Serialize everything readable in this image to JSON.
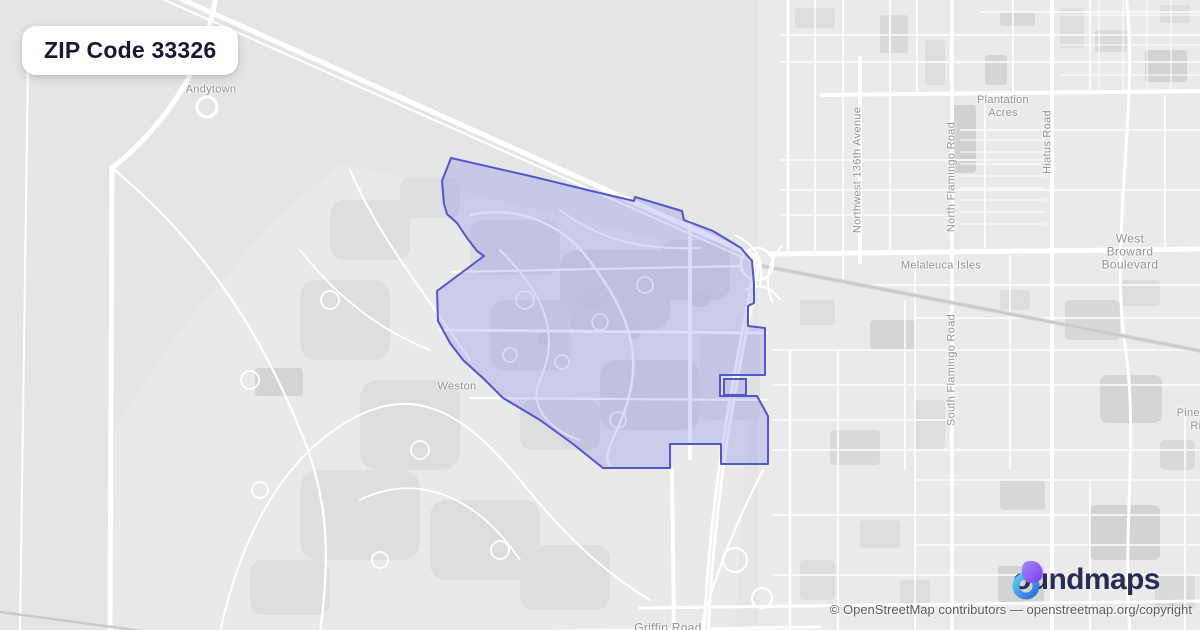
{
  "badge": {
    "label": "ZIP Code 33326"
  },
  "labels": {
    "andytown": "Andytown",
    "plantation_acres": "Plantation\nAcres",
    "melaleuca_isles": "Melaleuca Isles",
    "west_broward_blvd": "West Broward Boulevard",
    "weston": "Weston",
    "pine_island_ridge": "Pine Island\nRidge",
    "griffin_road": "Griffin Road",
    "nw_136th_ave": "Northwest 136th Avenue",
    "n_flamingo_rd": "North Flamingo Road",
    "hiatus_rd": "Hiatus Road",
    "s_flamingo_rd": "South Flamingo Road"
  },
  "boundary": {
    "zip": "33326",
    "stroke_color": "#5356cf",
    "fill_color": "rgba(114,120,232,0.26)",
    "points": [
      [
        451,
        158
      ],
      [
        530,
        176
      ],
      [
        600,
        193
      ],
      [
        634,
        201
      ],
      [
        635,
        197
      ],
      [
        682,
        211
      ],
      [
        684,
        220
      ],
      [
        713,
        231
      ],
      [
        741,
        248
      ],
      [
        752,
        261
      ],
      [
        754,
        284
      ],
      [
        754,
        303
      ],
      [
        748,
        306
      ],
      [
        748,
        326
      ],
      [
        765,
        328
      ],
      [
        765,
        375
      ],
      [
        720,
        375
      ],
      [
        720,
        396
      ],
      [
        757,
        396
      ],
      [
        768,
        416
      ],
      [
        768,
        464
      ],
      [
        721,
        464
      ],
      [
        721,
        444
      ],
      [
        670,
        444
      ],
      [
        670,
        468
      ],
      [
        603,
        468
      ],
      [
        573,
        444
      ],
      [
        540,
        420
      ],
      [
        503,
        398
      ],
      [
        485,
        380
      ],
      [
        463,
        360
      ],
      [
        450,
        343
      ],
      [
        438,
        321
      ],
      [
        437,
        291
      ],
      [
        484,
        256
      ],
      [
        477,
        251
      ],
      [
        467,
        238
      ],
      [
        457,
        223
      ],
      [
        447,
        214
      ],
      [
        444,
        204
      ],
      [
        442,
        181
      ]
    ],
    "enclave": {
      "x": 724,
      "y": 379,
      "w": 22,
      "h": 16
    }
  },
  "logo": {
    "brand_rest": "oundmaps",
    "icon": "boundmaps-pin-icon",
    "purple": "#8b5cf6",
    "blue_light": "#5bc8f2",
    "blue_dark": "#2f6fd6"
  },
  "attribution": {
    "text": "© OpenStreetMap contributors — openstreetmap.org/copyright"
  }
}
